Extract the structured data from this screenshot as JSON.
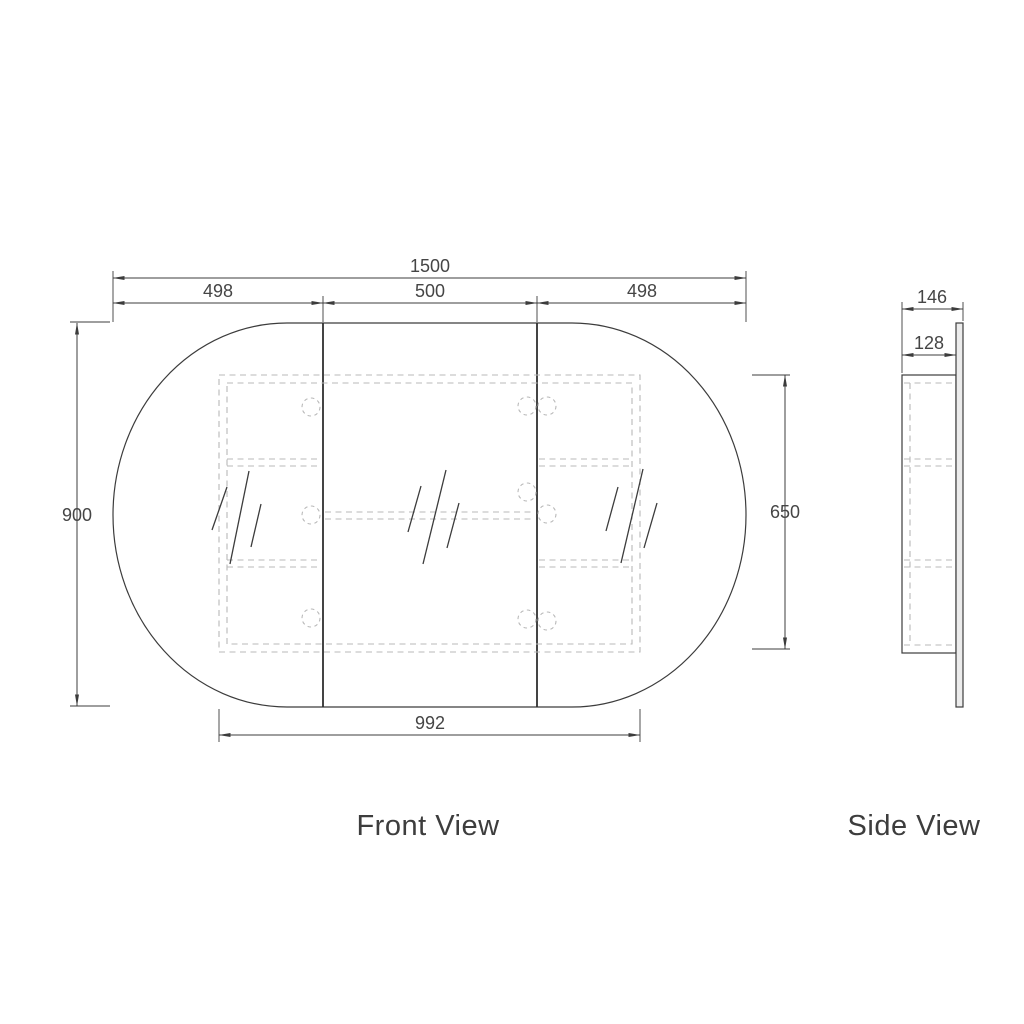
{
  "views": {
    "front": {
      "label": "Front View",
      "dimensions": {
        "overall_width_mm": "1500",
        "left_door_width_mm": "498",
        "center_door_width_mm": "500",
        "right_door_width_mm": "498",
        "overall_height_mm": "900",
        "carcass_height_mm": "650",
        "carcass_width_mm": "992"
      }
    },
    "side": {
      "label": "Side View",
      "dimensions": {
        "overall_depth_mm": "146",
        "carcass_depth_mm": "128"
      }
    }
  },
  "colors": {
    "line": "#3c3c3c",
    "hidden_line": "#b9b9b9",
    "text": "#454545",
    "background": "#ffffff"
  }
}
